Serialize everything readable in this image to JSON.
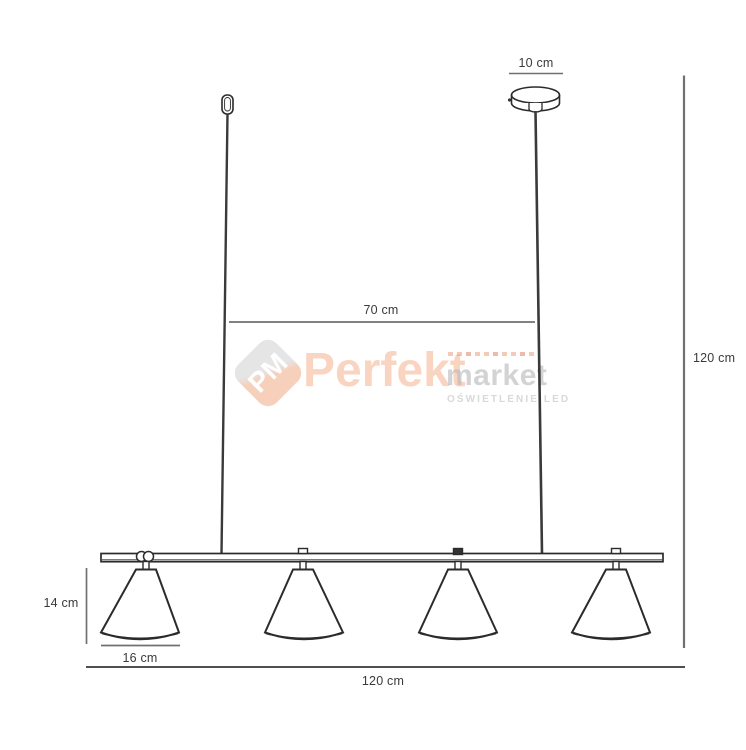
{
  "diagram": {
    "type": "pendant-lamp-dimension-drawing",
    "shade_count": 4,
    "dimensions": {
      "canopy_width": "10 cm",
      "suspension_span": "70 cm",
      "total_height": "120 cm",
      "shade_height": "14 cm",
      "shade_width": "16 cm",
      "total_width": "120 cm"
    }
  },
  "watermark": {
    "logo_monogram": "PM",
    "brand_primary": "Perfekt",
    "brand_secondary": "market",
    "tagline": "OŚWIETLENIE LED",
    "accent_color": "#ee7d3e",
    "secondary_color": "#b9b9b9"
  },
  "colors": {
    "background": "#ffffff",
    "outline": "#2b2b2b",
    "rod": "#3a3a3a",
    "dimension_line": "#707070",
    "label_text": "#3a3a3a"
  }
}
